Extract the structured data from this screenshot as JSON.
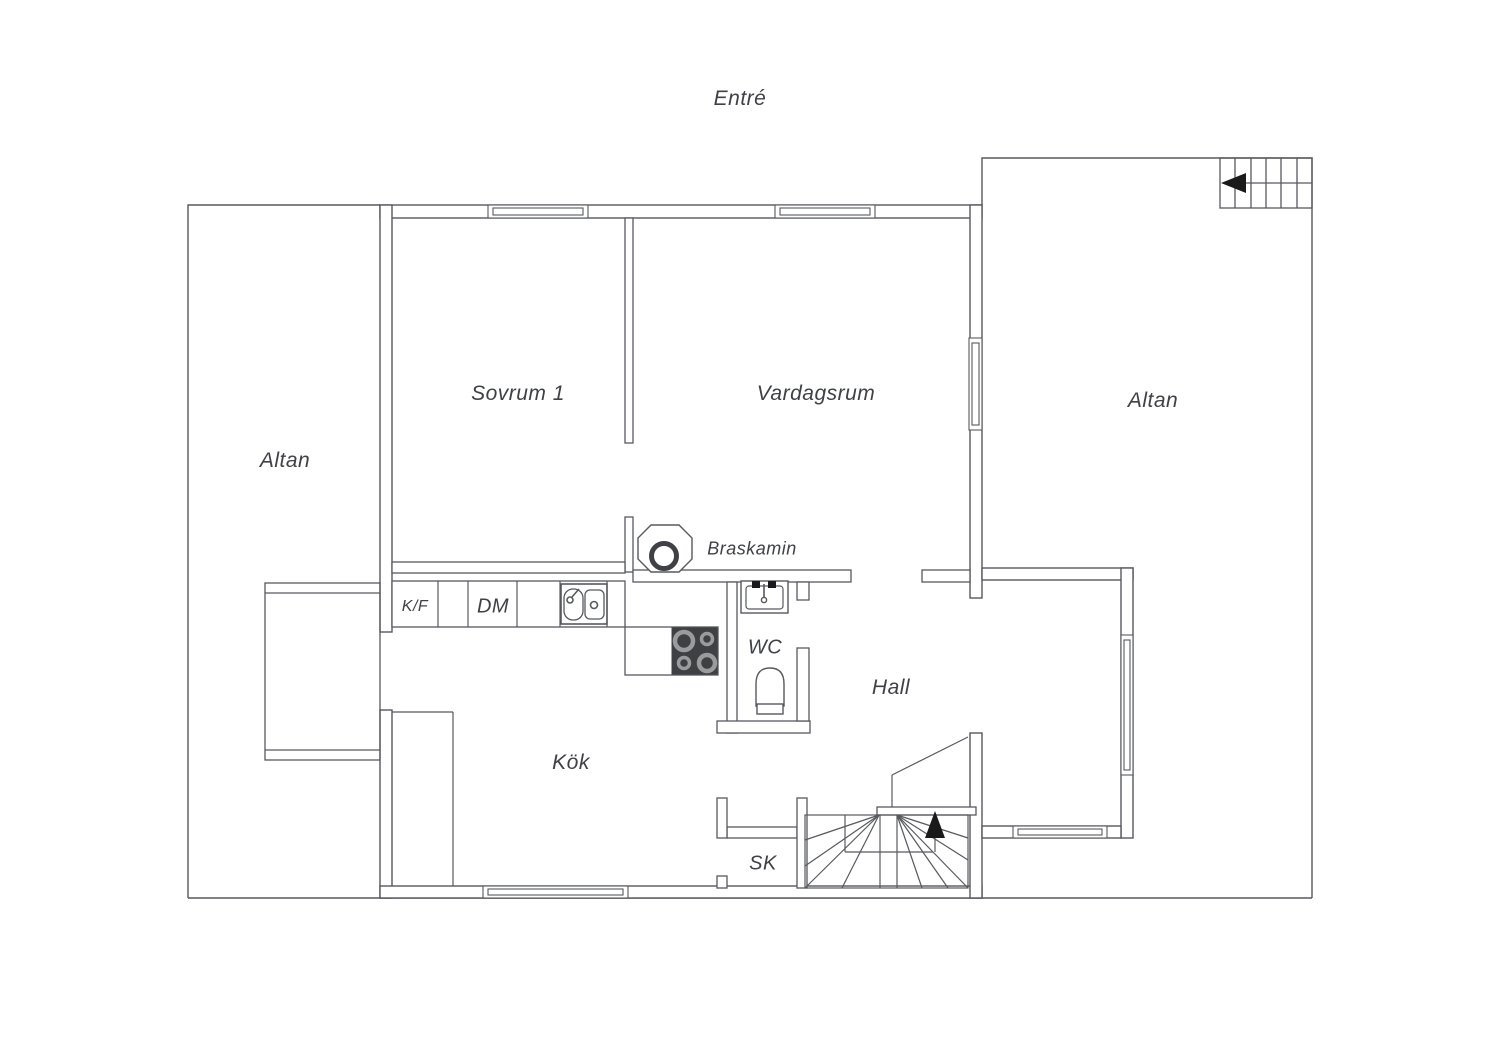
{
  "plan_title": "Entré",
  "labels": {
    "entre": "Entré",
    "sovrum1": "Sovrum 1",
    "vardagsrum": "Vardagsrum",
    "altan_left": "Altan",
    "altan_right": "Altan",
    "braskamin": "Braskamin",
    "kf": "K/F",
    "dm": "DM",
    "wc": "WC",
    "hall": "Hall",
    "kok": "Kök",
    "sk": "SK"
  },
  "colors": {
    "background": "#ffffff",
    "line": "#57595d",
    "text": "#3f4146",
    "stove_fill": "#3f4043",
    "burner_ring": "#9a9b9d",
    "arrow_fill": "#1a1a1a"
  }
}
